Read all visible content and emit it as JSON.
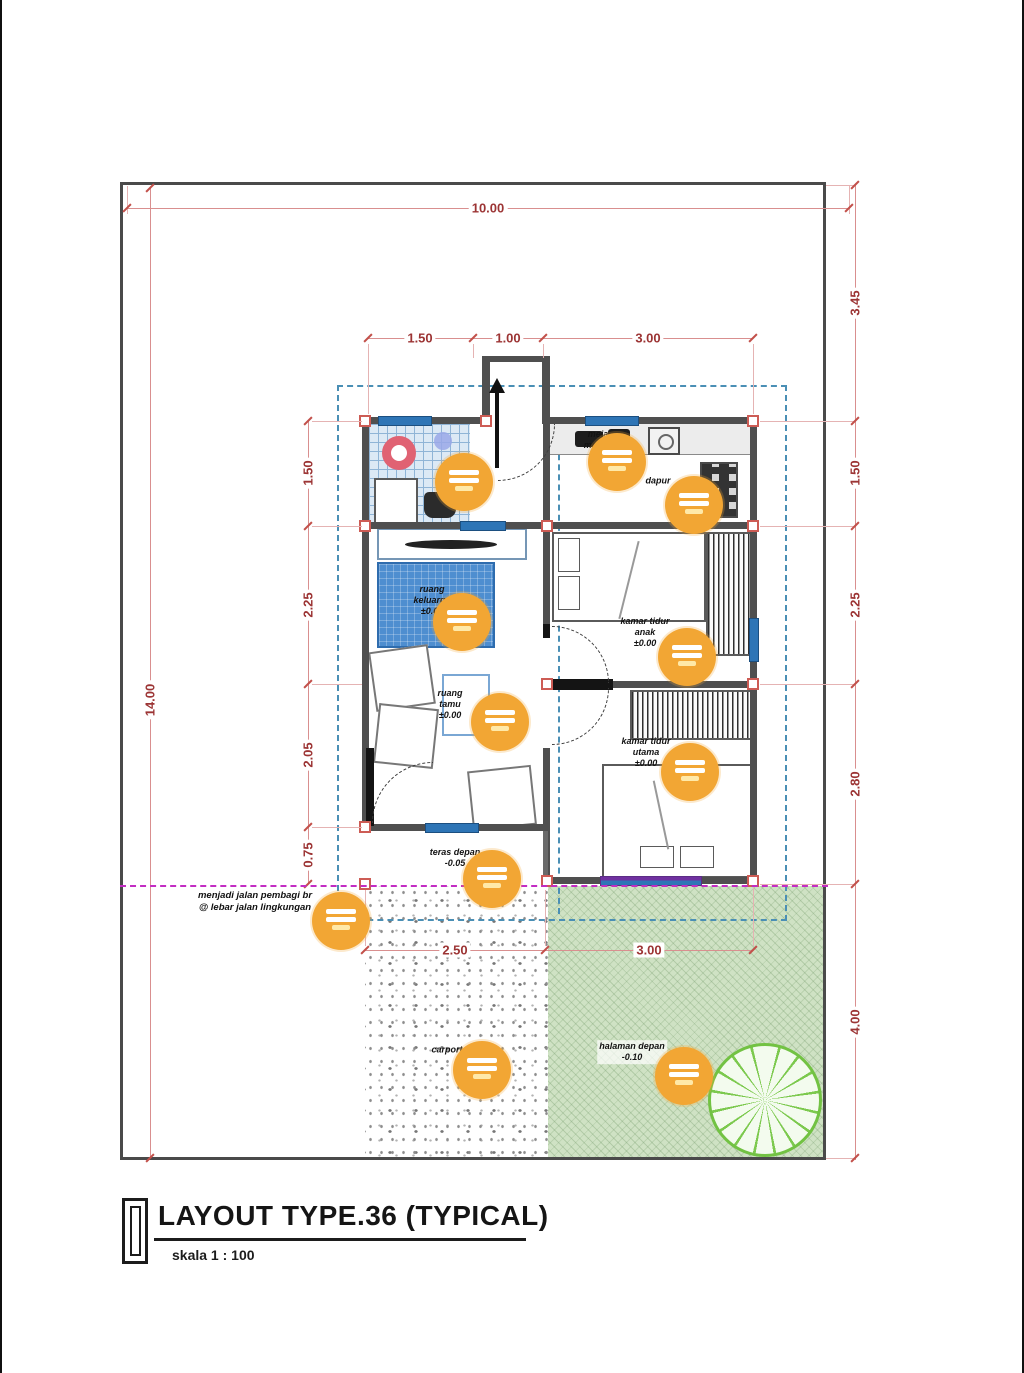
{
  "title_block": {
    "title": "LAYOUT TYPE.36 (TYPICAL)",
    "scale": "skala 1 : 100"
  },
  "dims": {
    "top_overall": "10.00",
    "top_inner": [
      "1.50",
      "1.00",
      "3.00"
    ],
    "left_overall": "14.00",
    "left_inner": [
      "1.50",
      "2.25",
      "2.05",
      "0.75"
    ],
    "right_inner": [
      "3.45",
      "1.50",
      "2.25",
      "2.80",
      "4.00"
    ],
    "bottom_inner": [
      "2.50",
      "3.00"
    ]
  },
  "labels": {
    "meja_makan": "meja\nmakan",
    "dapur": "dapur",
    "ruang_keluarga": "ruang\nkeluarga\n±0.00",
    "ruang_tamu": "ruang\ntamu\n±0.00",
    "kamar_anak": "kamar tidur\nanak\n±0.00",
    "kamar_utama": "kamar tidur\nutama\n±0.00",
    "teras": "teras depan\n-0.05",
    "carport": "carport",
    "halaman": "halaman depan\n-0.10",
    "road_note": "menjadi jalan pembagi br\n@ lebar jalan lingkungan"
  },
  "colors": {
    "dimension": "#9c3434",
    "marker": "#f2a634",
    "roof_line": "#4a8fb5",
    "grass": "#cfe2c4",
    "magenta": "#c32cc3",
    "wall": "#4f4f4f"
  }
}
